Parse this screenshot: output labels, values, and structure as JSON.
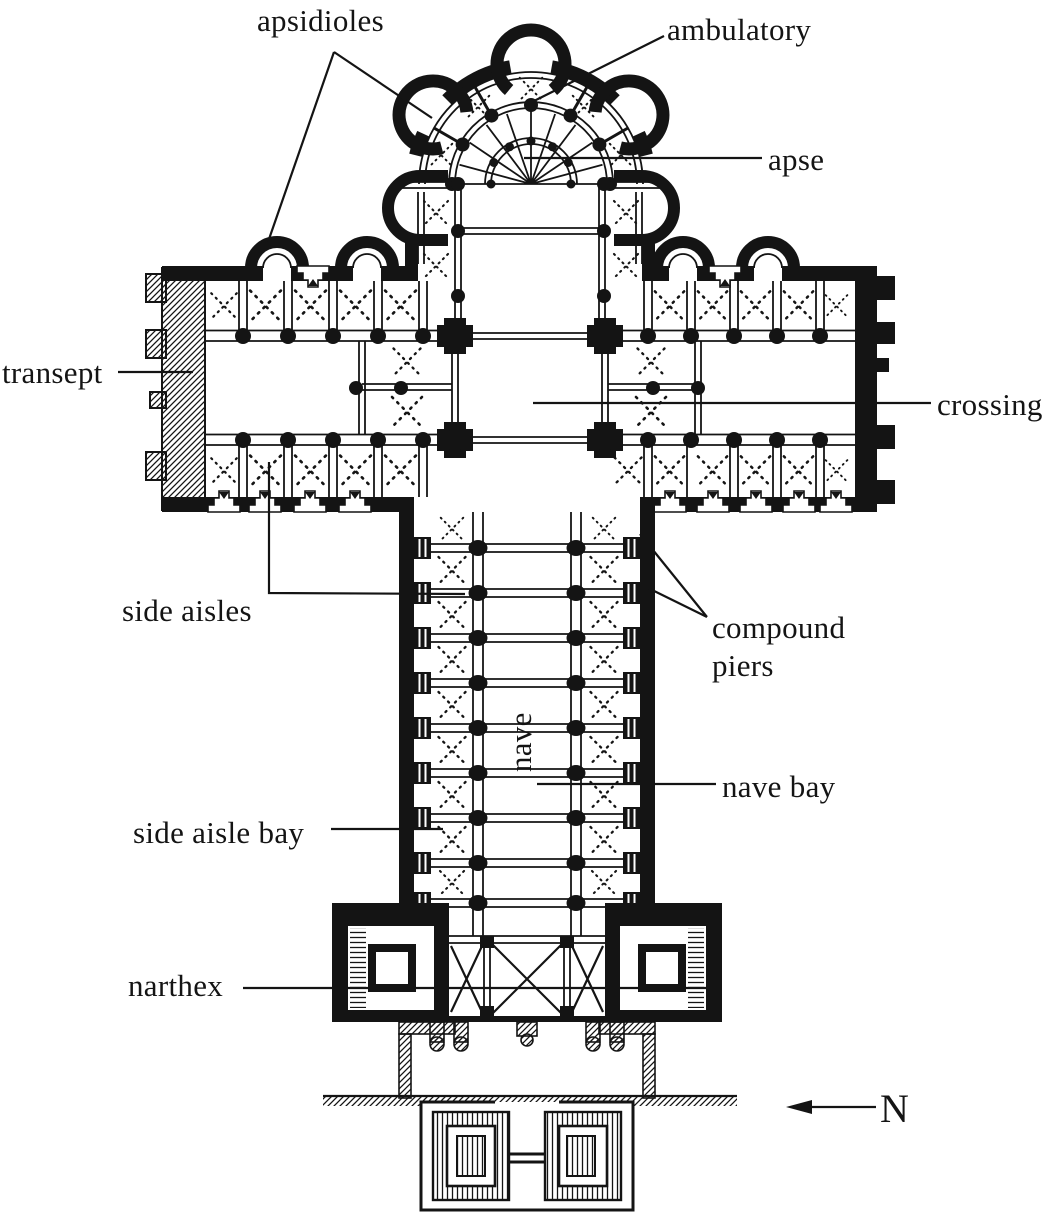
{
  "figure": {
    "kind": "architectural floor plan",
    "subject": "Romanesque pilgrimage church (cruciform basilica with chevet, transept, nave and narthex)",
    "background_color": "#ffffff",
    "ink_color": "#141414"
  },
  "labels": {
    "apsidioles": "apsidioles",
    "ambulatory": "ambulatory",
    "apse": "apse",
    "transept": "transept",
    "crossing": "crossing",
    "side_aisles": "side aisles",
    "compound_piers": {
      "line1": "compound",
      "line2": "piers"
    },
    "nave": "nave",
    "nave_bay": "nave bay",
    "side_aisle_bay": "side aisle bay",
    "narthex": "narthex"
  },
  "compass": {
    "north_label": "N",
    "arrow_direction": "left"
  }
}
